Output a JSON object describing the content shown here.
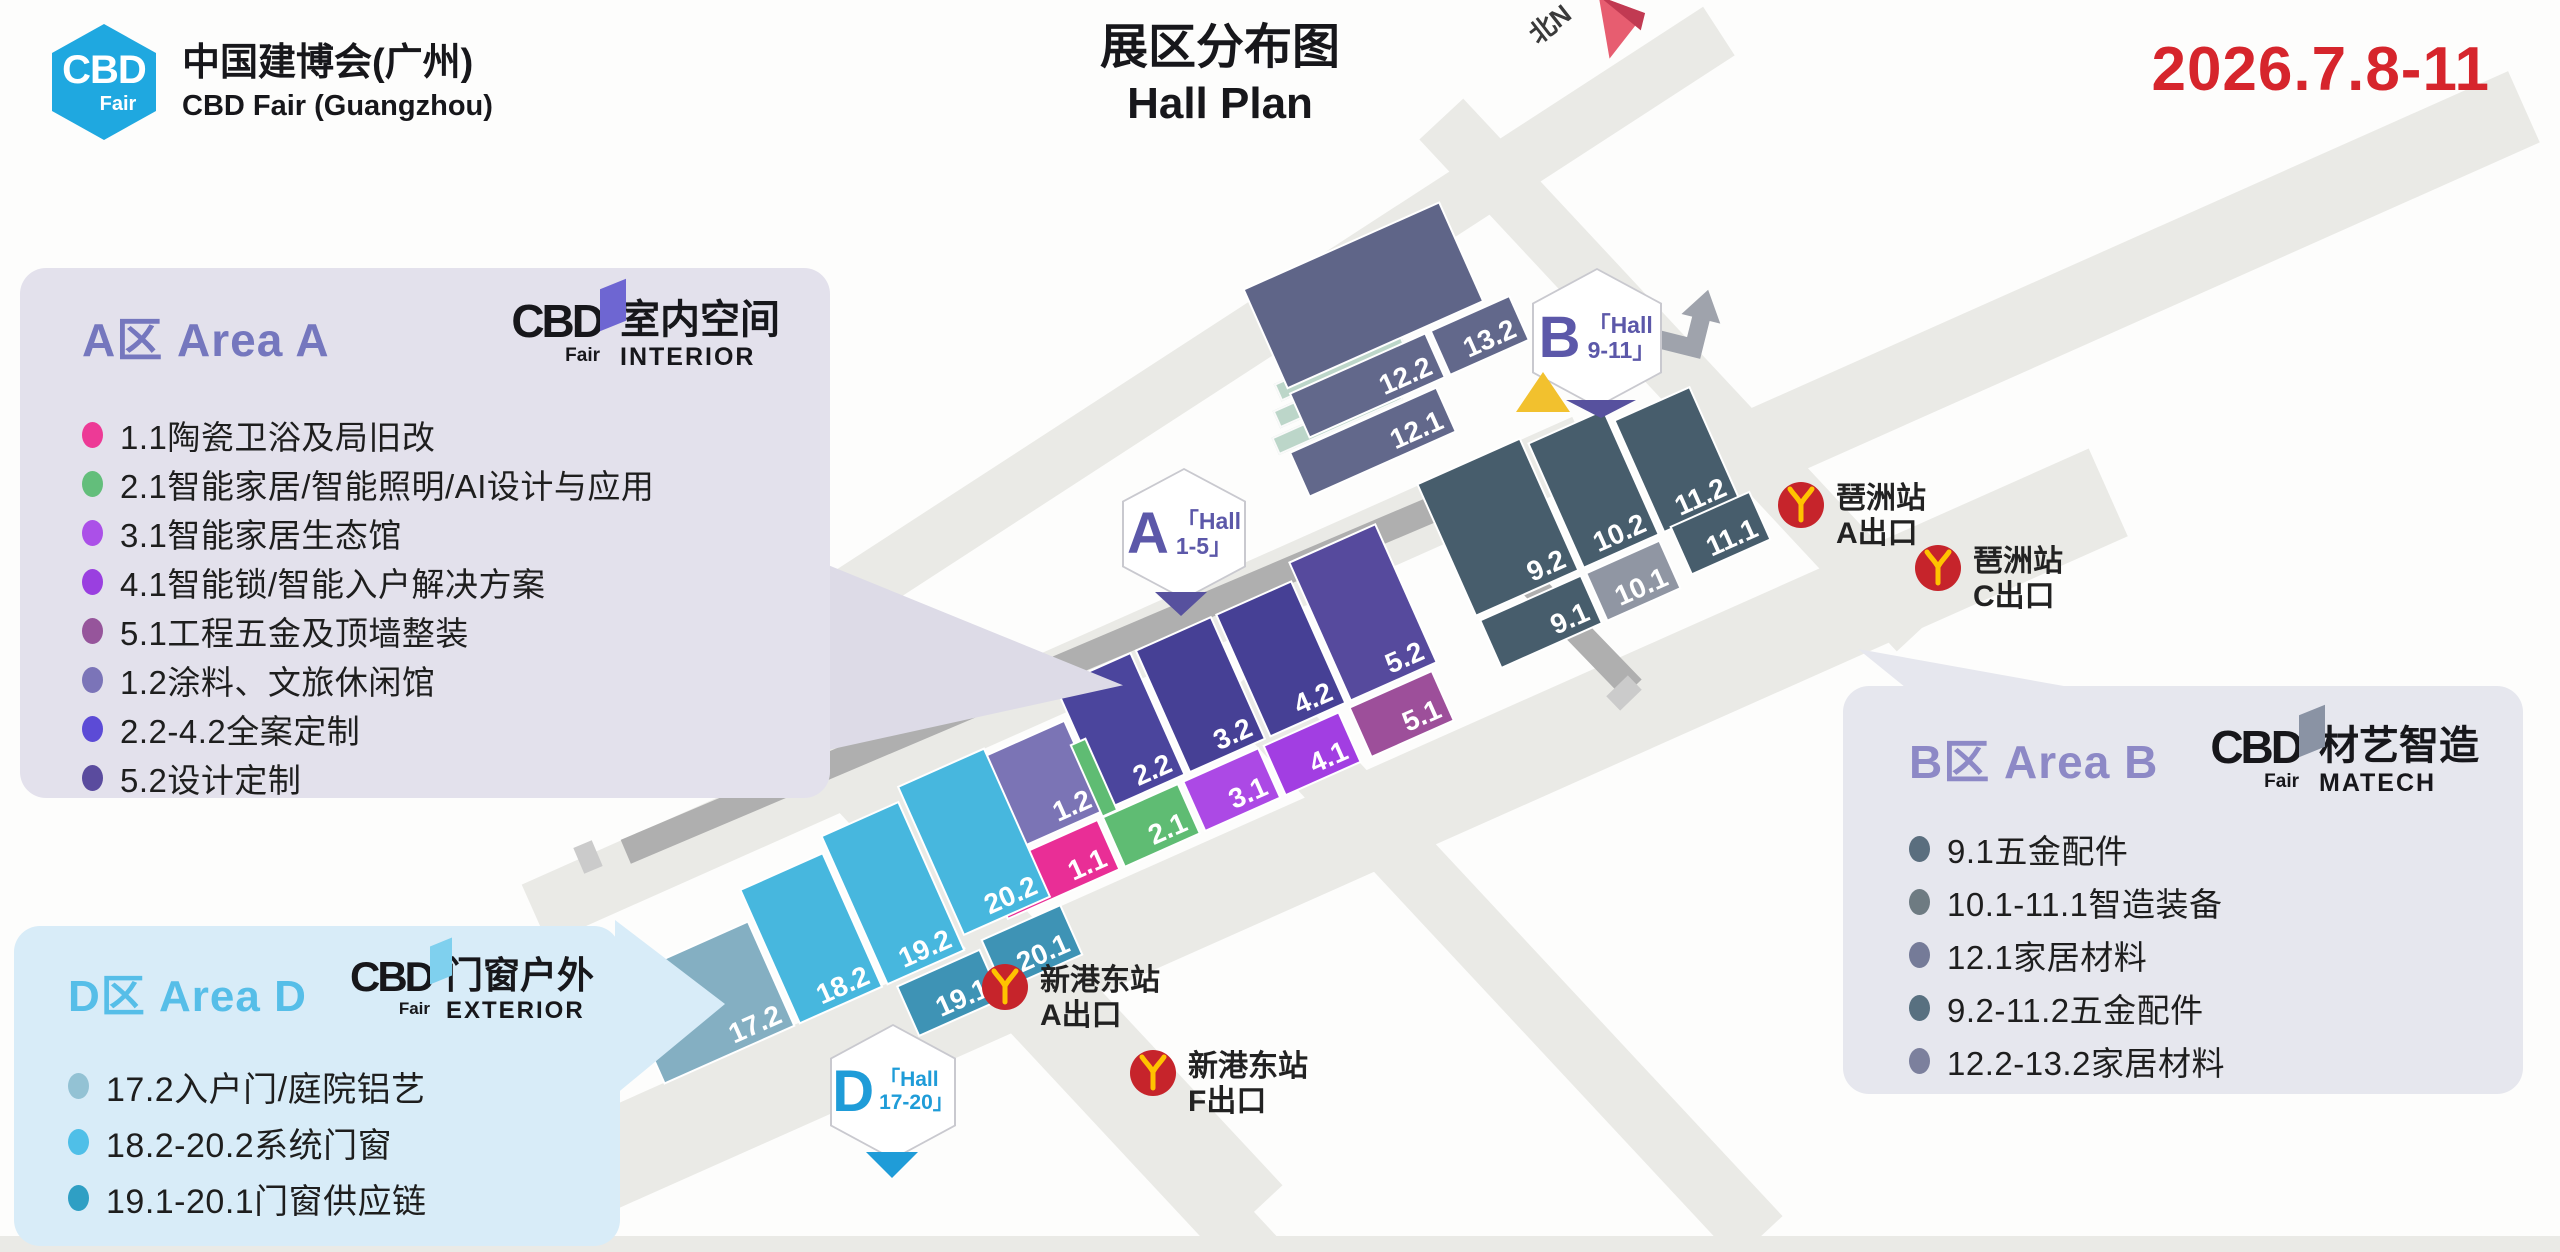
{
  "header": {
    "logo": {
      "hex_line1": "CBD",
      "hex_line2": "Fair",
      "hex_color": "#1FA8E0",
      "name_cn": "中国建博会(广州)",
      "name_en": "CBD Fair (Guangzhou)"
    },
    "title_cn": "展区分布图",
    "title_en": "Hall Plan",
    "date": "2026.7.8-11",
    "date_color": "#D6252C",
    "north_label": "北N"
  },
  "panels": {
    "a": {
      "title": "A区 Area A",
      "title_color": "#7577BE",
      "bg": "#E3E1EC",
      "logo": {
        "cbd": "CBD",
        "fair": "Fair",
        "flag_color": "#6E66D2",
        "brand_cn": "室内空间",
        "brand_en": "INTERIOR"
      },
      "items": [
        {
          "color": "#ED3A96",
          "text": "1.1陶瓷卫浴及局旧改"
        },
        {
          "color": "#63BE7B",
          "text": "2.1智能家居/智能照明/AI设计与应用"
        },
        {
          "color": "#AB50E8",
          "text": "3.1智能家居生态馆"
        },
        {
          "color": "#9A3FE0",
          "text": "4.1智能锁/智能入户解决方案"
        },
        {
          "color": "#96559B",
          "text": "5.1工程五金及顶墙整装"
        },
        {
          "color": "#7B74B8",
          "text": "1.2涂料、文旅休闲馆"
        },
        {
          "color": "#5C4BD6",
          "text": "2.2-4.2全案定制"
        },
        {
          "color": "#5A4B9E",
          "text": "5.2设计定制"
        }
      ]
    },
    "b": {
      "title": "B区 Area B",
      "title_color": "#8D89C6",
      "bg": "#E6E7EE",
      "logo": {
        "cbd": "CBD",
        "fair": "Fair",
        "flag_color": "#8A93A4",
        "brand_cn": "材艺智造",
        "brand_en": "MATECH"
      },
      "items": [
        {
          "color": "#5A6E7E",
          "text": "9.1五金配件"
        },
        {
          "color": "#6E7B82",
          "text": "10.1-11.1智造装备"
        },
        {
          "color": "#757B98",
          "text": "12.1家居材料"
        },
        {
          "color": "#587080",
          "text": "9.2-11.2五金配件"
        },
        {
          "color": "#7C809D",
          "text": "12.2-13.2家居材料"
        }
      ]
    },
    "d": {
      "title": "D区 Area D",
      "title_color": "#56BEE8",
      "bg": "#D8ECF8",
      "logo": {
        "cbd": "CBD",
        "fair": "Fair",
        "flag_color": "#7FD0EE",
        "brand_cn": "门窗户外",
        "brand_en": "EXTERIOR"
      },
      "items": [
        {
          "color": "#93C2D4",
          "text": "17.2入户门/庭院铝艺"
        },
        {
          "color": "#4FBFE8",
          "text": "18.2-20.2系统门窗"
        },
        {
          "color": "#2F9FC4",
          "text": "19.1-20.1门窗供应链"
        }
      ]
    }
  },
  "map": {
    "halls_a": [
      {
        "label": "1.2",
        "color": "#7B74B5"
      },
      {
        "label": "2.2",
        "color": "#4B459D"
      },
      {
        "label": "3.2",
        "color": "#464095"
      },
      {
        "label": "4.2",
        "color": "#464095"
      },
      {
        "label": "5.2",
        "color": "#564A9D"
      },
      {
        "label": "1.1",
        "color": "#E92E96"
      },
      {
        "label": "2.1",
        "color": "#5FBC73"
      },
      {
        "label": "3.1",
        "color": "#AC49E5"
      },
      {
        "label": "4.1",
        "color": "#A23EE2"
      },
      {
        "label": "5.1",
        "color": "#9D4F9A"
      }
    ],
    "halls_b": [
      {
        "label": "9.2",
        "color": "#475D6C"
      },
      {
        "label": "10.2",
        "color": "#475D6C"
      },
      {
        "label": "11.2",
        "color": "#475D6C"
      },
      {
        "label": "9.1",
        "color": "#475D6C"
      },
      {
        "label": "10.1",
        "color": "#9096A3"
      },
      {
        "label": "11.1",
        "color": "#475D6C"
      }
    ],
    "halls_top": [
      {
        "label": "",
        "color": "#5F6588"
      },
      {
        "label": "12.2",
        "color": "#62688B"
      },
      {
        "label": "13.2",
        "color": "#62688B"
      },
      {
        "label": "12.1",
        "color": "#62688B"
      }
    ],
    "halls_d": [
      {
        "label": "17.2",
        "color": "#84AFC2"
      },
      {
        "label": "18.2",
        "color": "#47B7DE"
      },
      {
        "label": "19.2",
        "color": "#47B7DE"
      },
      {
        "label": "20.2",
        "color": "#47B7DE"
      },
      {
        "label": "19.1",
        "color": "#3E93B5"
      },
      {
        "label": "20.1",
        "color": "#3E93B5"
      }
    ],
    "hexagons": {
      "a": {
        "letter": "A",
        "line1": "「Hall",
        "line2": "1-5」",
        "color": "#5C58A9"
      },
      "b": {
        "letter": "B",
        "line1": "「Hall",
        "line2": "9-11」",
        "color": "#5C58A9"
      },
      "d": {
        "letter": "D",
        "line1": "「Hall",
        "line2": "17-20」",
        "color": "#1F9CD8"
      }
    },
    "metro_exits": [
      {
        "station": "琶洲站",
        "exit": "A出口"
      },
      {
        "station": "琶洲站",
        "exit": "C出口"
      },
      {
        "station": "新港东站",
        "exit": "A出口"
      },
      {
        "station": "新港东站",
        "exit": "F出口"
      }
    ],
    "metro_color": "#C6242B",
    "metro_y_color": "#FFC300"
  }
}
